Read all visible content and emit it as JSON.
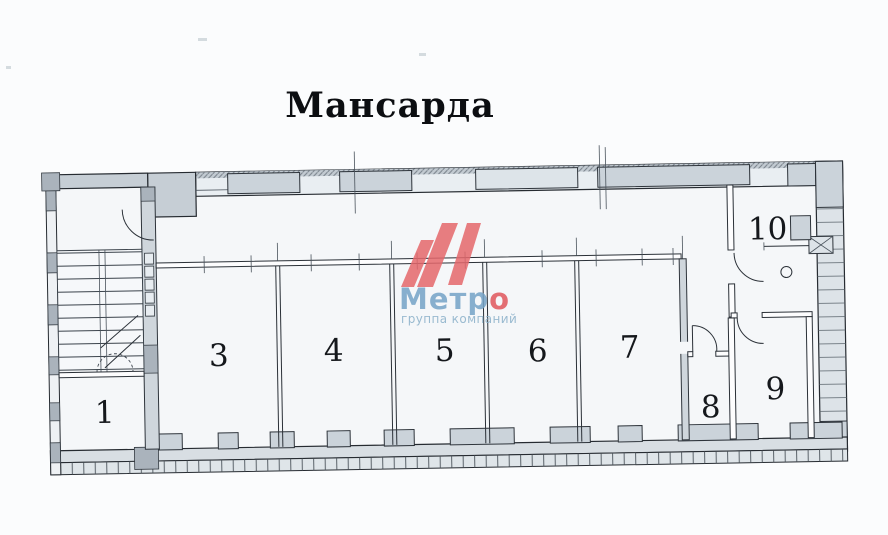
{
  "title": "Мансарда",
  "rooms": [
    {
      "number": "1"
    },
    {
      "number": "3"
    },
    {
      "number": "4"
    },
    {
      "number": "5"
    },
    {
      "number": "6"
    },
    {
      "number": "7"
    },
    {
      "number": "8"
    },
    {
      "number": "9"
    },
    {
      "number": "10"
    }
  ],
  "watermark": {
    "company_full": "Метро",
    "company_main": "Метр",
    "company_accent": "о",
    "subtitle": "группа компаний",
    "colors": {
      "logo_red": "#e5686c",
      "accent_red": "#e0575c",
      "text_blue": "#74a3c7",
      "subtitle_blue": "#8ab0c9"
    }
  }
}
